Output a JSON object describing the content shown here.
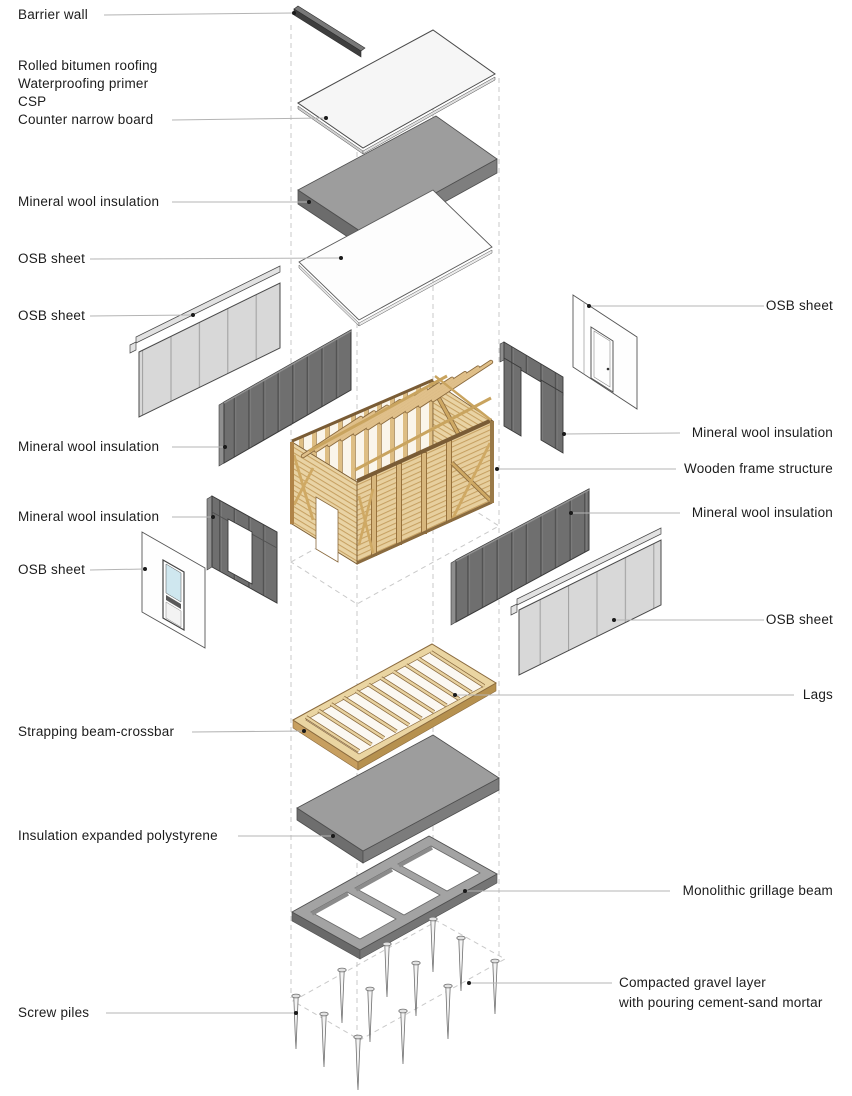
{
  "diagram": {
    "type": "exploded-axonometric-construction-diagram",
    "subject": "layered wall/roof/foundation build-up of a timber frame modular house"
  },
  "labels": {
    "barrier_wall": "Barrier wall",
    "roofing_stack": [
      "Rolled bitumen roofing",
      "Waterproofing primer",
      "CSP",
      "Counter narrow board"
    ],
    "mineral_wool_roof": "Mineral wool insulation",
    "osb_roof": "OSB sheet",
    "osb_wall_nw": "OSB sheet",
    "mineral_wool_nw": "Mineral wool insulation",
    "mineral_wool_end": "Mineral wool insulation",
    "osb_end": "OSB sheet",
    "strapping_beam": "Strapping beam-crossbar",
    "insulation_eps": "Insulation expanded polystyrene",
    "screw_piles": "Screw piles",
    "osb_door": "OSB sheet",
    "mineral_wool_door": "Mineral wool insulation",
    "wooden_frame": "Wooden frame structure",
    "mineral_wool_se": "Mineral wool insulation",
    "osb_se": "OSB sheet",
    "lags": "Lags",
    "grillage": "Monolithic grillage beam",
    "gravel_lines": [
      "Compacted gravel layer",
      "with pouring cement-sand mortar"
    ]
  },
  "colors": {
    "background": "#ffffff",
    "label_text": "#1c1c1c",
    "leader_line": "#b4b4b4",
    "leader_dot": "#1a1a1a",
    "dashed_guide": "#c9c9c9",
    "wood_light": "#e9d2a2",
    "wood_dark": "#8a6a3e",
    "mineral_wool_gray": "#6f6f6f",
    "osb_gray": "#d8d8d8",
    "concrete_gray": "#9d9d9d",
    "window_glass": "#cfe7ef"
  }
}
